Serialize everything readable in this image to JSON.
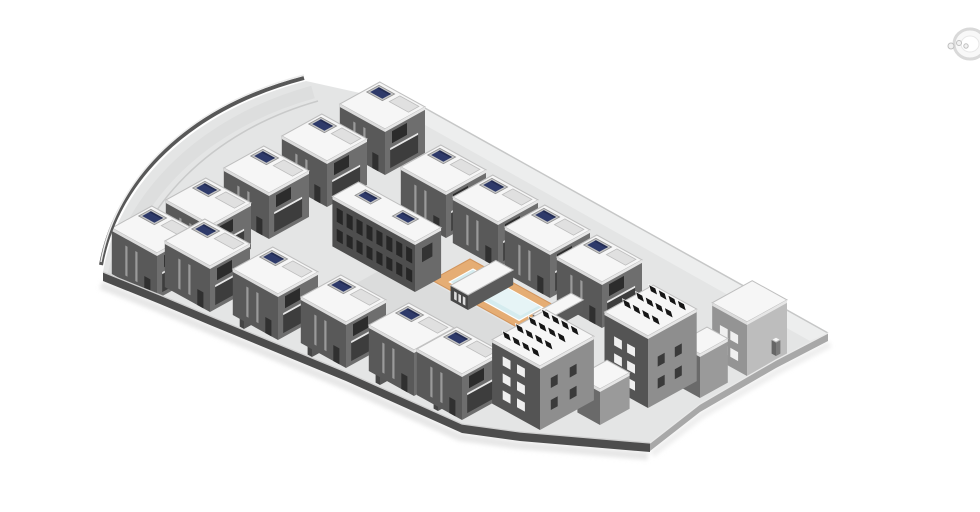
{
  "viewport": {
    "width": 980,
    "height": 512,
    "background": "#ffffff",
    "kind": "architectural-site-model-render"
  },
  "iso": {
    "kx": 0.87,
    "ky": 0.48
  },
  "palette": {
    "plane": "#e4e5e5",
    "plane_light": "#edeeee",
    "road": "#dddede",
    "curb": "#c9caca",
    "wall_dark": "#4d4d4d",
    "wall_dark_cap": "#d0d0d0",
    "wall_light": "#a8a8a8",
    "wall_light_cap": "#e9e9e9",
    "edge_line": "#c6c7c7",
    "shadow": "#d9d9d9",
    "roof": "#f6f6f6",
    "roof_edge": "#bfbfbf",
    "pv_blue": "#2e3a6a",
    "pv_blue_dark": "#232c52",
    "pv_frame": "#c6c6c6",
    "pv_frame_edge": "#8f8f8f",
    "panel_black": "#161616",
    "panel_white": "#fafafa",
    "deck": "#e5ad74",
    "deck_edge": "#d1945c",
    "water": "#d5ecef",
    "water_light": "#e9f6f7",
    "patio": "#dbdcdc",
    "bulkhead": "#e0e0e0",
    "bulkhead_edge": "#bdbdbd",
    "glass_dark": "#262626",
    "window_white": "#efefef",
    "window_dark": "#3a3a3a",
    "slit": "#9a9a9a",
    "balcony": "#3d3d3d",
    "parapet_left": "#dcdcdc",
    "parapet_right": "#e6e6e6"
  },
  "site": {
    "outline_path": "M103,272 C118,186 188,112 306,81 L423,107 L828,333 L776,360 L700,404 L650,443 L520,432 L462,424 L346,372 L278,344 L210,316 L160,295 Z",
    "ne_band": [
      [
        423,
        107
      ],
      [
        828,
        333
      ],
      [
        810,
        341
      ],
      [
        409,
        116
      ]
    ],
    "curve_wall_path": "M101,265 C116,182 186,109 304,78",
    "curve_wall_cap_path": "M101,262 C116,179 186,106 304,75",
    "curve_road_path": "M113,279 C131,197 201,123 313,92",
    "curve_curb_path": "M122,288 C140,208 208,132 318,101",
    "ne_edge": [
      [
        423,
        107
      ],
      [
        828,
        333
      ]
    ],
    "walls_bottom_left": [
      [
        103,
        272
      ],
      [
        160,
        295
      ],
      [
        210,
        316
      ],
      [
        278,
        344
      ],
      [
        346,
        372
      ],
      [
        462,
        424
      ],
      [
        520,
        432
      ],
      [
        650,
        443
      ]
    ],
    "walls_bottom_right": [
      [
        828,
        333
      ],
      [
        776,
        360
      ],
      [
        700,
        404
      ],
      [
        650,
        443
      ]
    ],
    "wall_thickness": 9,
    "gate_pillar": {
      "front": [
        776,
        356
      ],
      "du": 5,
      "dv": 5,
      "h": 14
    },
    "patio": {
      "c": [
        395,
        262
      ],
      "du": 190,
      "dv": 62
    }
  },
  "pool": {
    "deck": {
      "c": [
        470,
        259
      ],
      "du": 105,
      "dv": 44
    },
    "water": {
      "c": [
        473,
        269
      ],
      "du": 80,
      "dv": 27
    },
    "water_inner": {
      "c": [
        478,
        272
      ],
      "du": 70,
      "dv": 21
    }
  },
  "building_styles": {
    "villa": {
      "du": 52,
      "dv": 46,
      "h": 46,
      "left": "#595959",
      "right": "#6e6e6e",
      "features": [
        "pv_box",
        "bulkhead",
        "slits",
        "balcony",
        "parapet"
      ]
    },
    "townhouse": {
      "du": 95,
      "dv": 30,
      "h": 50,
      "left": "#4e4e4e",
      "right": "#6a6a6a",
      "features": [
        "window_grid",
        "pv_box2",
        "parapet"
      ]
    },
    "apartment": {
      "du": 55,
      "dv": 62,
      "h": 64,
      "left": "#545454",
      "right": "#8e8e8e",
      "features": [
        "white_windows",
        "dark_windows_right",
        "pv_array",
        "parapet"
      ]
    },
    "apartment_light": {
      "du": 40,
      "dv": 46,
      "h": 54,
      "left": "#949494",
      "right": "#bdbdbd",
      "features": [
        "white_windows",
        "parapet"
      ]
    },
    "wing": {
      "du": 26,
      "dv": 34,
      "h": 36,
      "left": "#6a6a6a",
      "right": "#9a9a9a",
      "features": [
        "parapet"
      ]
    },
    "poolhouse": {
      "du": 20,
      "dv": 52,
      "h": 15,
      "left": "#474747",
      "right": "#5a5a5a",
      "features": [
        "light_slits"
      ]
    },
    "gardenwall": {
      "du": 28,
      "dv": 5,
      "h": 14,
      "left": "#454545",
      "right": "#585858",
      "features": []
    }
  },
  "buildings": [
    {
      "id": "villa-nw-1",
      "type": "villa",
      "front": [
        385,
        175
      ]
    },
    {
      "id": "gardenwall-nw-1",
      "type": "gardenwall",
      "front": [
        346,
        195
      ]
    },
    {
      "id": "villa-nw-2",
      "type": "villa",
      "front": [
        327,
        207
      ]
    },
    {
      "id": "gardenwall-nw-2",
      "type": "gardenwall",
      "front": [
        288,
        227
      ]
    },
    {
      "id": "villa-ne-1",
      "type": "villa",
      "front": [
        446,
        238
      ]
    },
    {
      "id": "villa-nw-3",
      "type": "villa",
      "front": [
        269,
        239
      ]
    },
    {
      "id": "gardenwall-nw-3",
      "type": "gardenwall",
      "front": [
        230,
        259
      ]
    },
    {
      "id": "villa-ne-2",
      "type": "villa",
      "front": [
        498,
        268
      ]
    },
    {
      "id": "villa-nw-4",
      "type": "villa",
      "front": [
        211,
        271
      ]
    },
    {
      "id": "gardenwall-nw-4",
      "type": "gardenwall",
      "front": [
        174,
        289
      ]
    },
    {
      "id": "townhouse-center",
      "type": "townhouse",
      "front": [
        415,
        292
      ]
    },
    {
      "id": "villa-ne-3",
      "type": "villa",
      "front": [
        550,
        298
      ]
    },
    {
      "id": "villa-nw-5",
      "type": "villa",
      "front": [
        157,
        299
      ]
    },
    {
      "id": "poolhouse",
      "type": "poolhouse",
      "front": [
        468,
        310
      ]
    },
    {
      "id": "villa-w-1",
      "type": "villa",
      "front": [
        210,
        312
      ]
    },
    {
      "id": "villa-ne-4",
      "type": "villa",
      "front": [
        602,
        328
      ]
    },
    {
      "id": "gardenwall-w-1",
      "type": "gardenwall",
      "front": [
        244,
        329
      ],
      "du": 5,
      "dv": 28
    },
    {
      "id": "pool-bar",
      "type": "poolhouse",
      "front": [
        545,
        333
      ],
      "du": 14,
      "dv": 44,
      "h": 12
    },
    {
      "id": "villa-w-2",
      "type": "villa",
      "front": [
        278,
        340
      ]
    },
    {
      "id": "gardenwall-w-2",
      "type": "gardenwall",
      "front": [
        312,
        357
      ],
      "du": 5,
      "dv": 28
    },
    {
      "id": "villa-w-3",
      "type": "villa",
      "front": [
        346,
        368
      ]
    },
    {
      "id": "tower-se",
      "type": "apartment_light",
      "front": [
        747,
        376
      ]
    },
    {
      "id": "gardenwall-w-3",
      "type": "gardenwall",
      "front": [
        380,
        385
      ],
      "du": 5,
      "dv": 28
    },
    {
      "id": "villa-w-4",
      "type": "villa",
      "front": [
        414,
        396
      ]
    },
    {
      "id": "wing-se-2",
      "type": "wing",
      "front": [
        700,
        398
      ],
      "du": 24,
      "dv": 32,
      "h": 44
    },
    {
      "id": "apartment-se-2",
      "type": "apartment",
      "front": [
        648,
        408
      ],
      "du": 50,
      "dv": 56,
      "h": 72
    },
    {
      "id": "gardenwall-w-4",
      "type": "gardenwall",
      "front": [
        438,
        411
      ],
      "du": 5,
      "dv": 28
    },
    {
      "id": "villa-w-5",
      "type": "villa",
      "front": [
        462,
        420
      ]
    },
    {
      "id": "wing-se-1",
      "type": "wing",
      "front": [
        600,
        425
      ]
    },
    {
      "id": "apartment-se-1",
      "type": "apartment",
      "front": [
        540,
        430
      ]
    }
  ],
  "nav_widget": {
    "cx": 970,
    "cy": 44,
    "rx": 16,
    "ry": 15,
    "ring": "#d5d5d5",
    "fill": "#f8f8f8",
    "glyph": "#b9b9b9"
  }
}
